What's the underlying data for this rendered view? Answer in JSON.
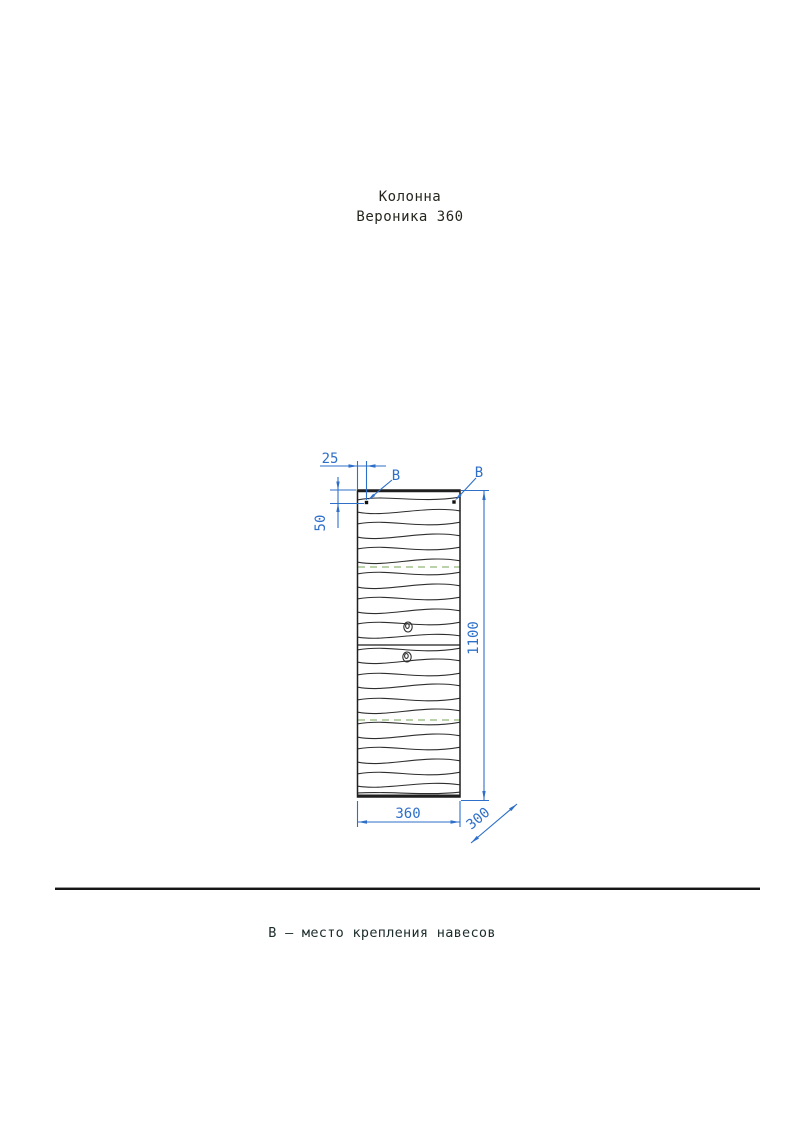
{
  "title": {
    "line1": "Колонна",
    "line2": "Вероника 360"
  },
  "drawing": {
    "dimensions": {
      "edge_offset": "25",
      "top_offset": "50",
      "height": "1100",
      "width": "360",
      "depth": "300"
    },
    "attachment_label_left": "В",
    "attachment_label_right": "В",
    "colors": {
      "dimension_blue": "#2e6fc9",
      "outline": "#1f1f1f",
      "grain": "#2e2e2e",
      "shelf_dashed_green": "#a3c48e"
    }
  },
  "footnote": {
    "text": "В – место крепления навесов"
  }
}
